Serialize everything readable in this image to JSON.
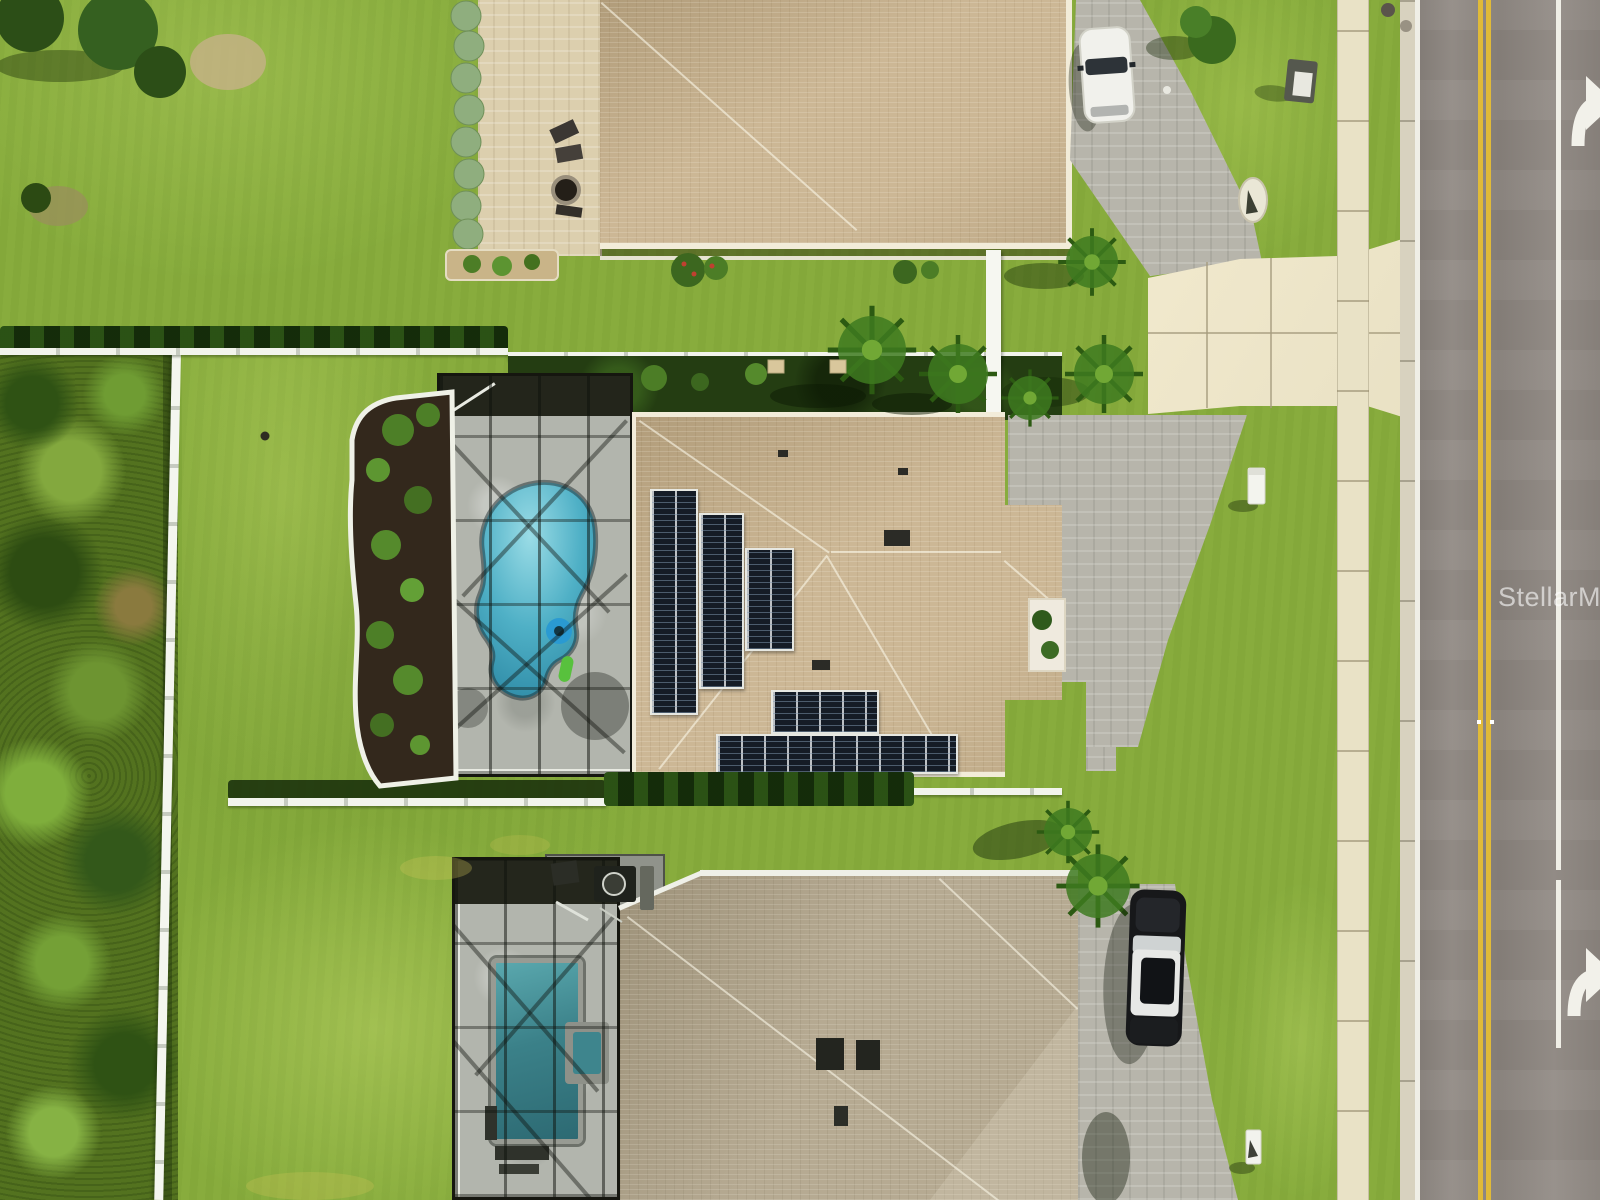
{
  "type": "aerial-drone-real-estate-photo",
  "watermark": {
    "text": "StellarMLS",
    "color": "#ffffff",
    "opacity": 0.6
  },
  "scene": {
    "description": "Overhead drone view of three suburban homes along a vertical two-lane road with sidewalk; the center home has rooftop solar arrays and a freeform pool inside a screened lanai; an unmown brush lot lies to the west behind a white fence",
    "road": {
      "position": "right edge, running vertically",
      "surface": "gray asphalt",
      "center_line": "double solid yellow",
      "west_edge_line": "solid white",
      "lane_line": "solid white, broken near bottom",
      "markings": [
        "white right-turn arrow near top (cut off at edge)",
        "white right-turn arrow near bottom (cut off at edge)"
      ],
      "sidewalk": "cream concrete sidewalk west of road with regular joints",
      "curb": "concrete curb and gutter with manhole covers at top"
    },
    "center_home": {
      "roof": "tan shingle hip roof",
      "solar": "dark solar panel arrays stepped on west slope plus two rows on south slope",
      "pool": "freeform blue pool with blue ring float and green float, gray paver deck, bronze screen enclosure casting grid shadows",
      "landscaping": "dark mulch bed with tropical plants and white curb edging; white vinyl rear fence with palms and potted plants",
      "driveway": "gray paver driveway with curved edge joining a cream concrete apron at the road",
      "mailbox": "white mailbox at street"
    },
    "upper_home": {
      "roof": "tan shingle hip roof",
      "vehicle": "white car parked on gray paver driveway",
      "backyard": "cream paver patio with two lounge chairs, round fire pit, bench, and a row of silver-green shrubs"
    },
    "lower_home": {
      "roof": "gray-tan shingle hip roof with dark roof vents",
      "pool": "rectangular teal pool with attached spa inside screened lanai; pool equipment pad at rear",
      "vehicle": "dark SUV with white roof parked on gray paver driveway",
      "mailbox": "white mailbox at street"
    },
    "west_lot": "wild brush and scrub separated from mowed lawns by a white vinyl fence",
    "fences": [
      "white vinyl fence along west property line",
      "white rear fences between yards",
      "dark hedge rows along property lines"
    ]
  },
  "palette": {
    "lawn_green": "#86ab3c",
    "brush_green": "#53721f",
    "roof_tan": "#ccb795",
    "roof_gray_tan": "#b6aa92",
    "solar_panel": "#151c26",
    "pool_water": "#4fb0c6",
    "pool_water_dark": "#3b8189",
    "paver_gray": "#b7b5ab",
    "patio_cream": "#dccfae",
    "concrete_cream": "#eee7cb",
    "sidewalk": "#e9e2c6",
    "asphalt": "#8f8882",
    "center_line_yellow": "#e0ba38",
    "marking_white": "#efeee6",
    "fence_white": "#f2f4ec",
    "mulch_brown": "#33281c",
    "screen_dark": "#23251b"
  }
}
